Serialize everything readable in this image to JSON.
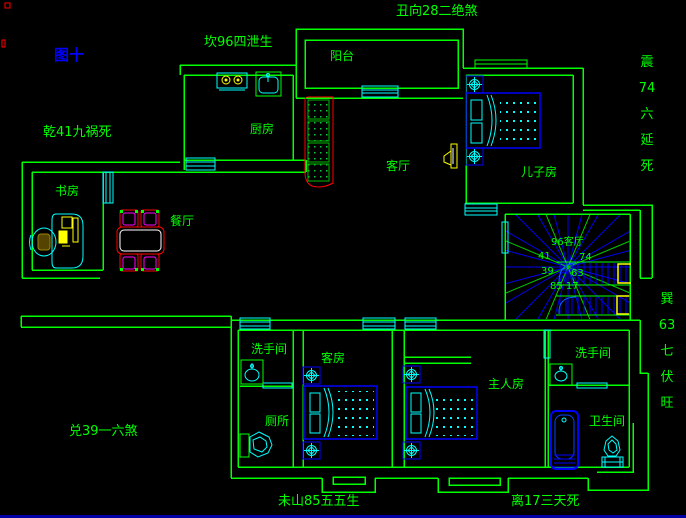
{
  "figure_label": "图十",
  "fengshui": {
    "top_facing": "丑向28二绝煞",
    "top_left": "坎96四泄生",
    "left": "乾41九祸死",
    "right_upper_vertical": [
      "震",
      "74",
      "六",
      "延",
      "死"
    ],
    "right_lower_vertical": [
      "巽",
      "63",
      "七",
      "伏",
      "旺"
    ],
    "bottom_left": "兑39一六煞",
    "bottom_center": "未山85五五生",
    "bottom_right": "离17三天死"
  },
  "rooms": {
    "balcony": "阳台",
    "kitchen": "厨房",
    "living_room": "客厅",
    "son_room": "儿子房",
    "study": "书房",
    "dining_room": "餐厅",
    "washroom_left": "洗手间",
    "guest_room": "客房",
    "toilet": "厕所",
    "master_room": "主人房",
    "washroom_right": "洗手间",
    "bathroom": "卫生间"
  },
  "stair_compass": {
    "top": "96客厅",
    "nw": "41",
    "ne": "74",
    "w": "39",
    "e": "63",
    "s": "85 17"
  },
  "colors": {
    "background": "#000000",
    "wall_green": "#00ff00",
    "fixture_cyan": "#00ffff",
    "furniture_blue": "#0000ff",
    "accent_yellow": "#ffff00",
    "accent_red": "#ff0000",
    "accent_magenta": "#ff00ff",
    "figure_label_blue": "#0000ff"
  }
}
